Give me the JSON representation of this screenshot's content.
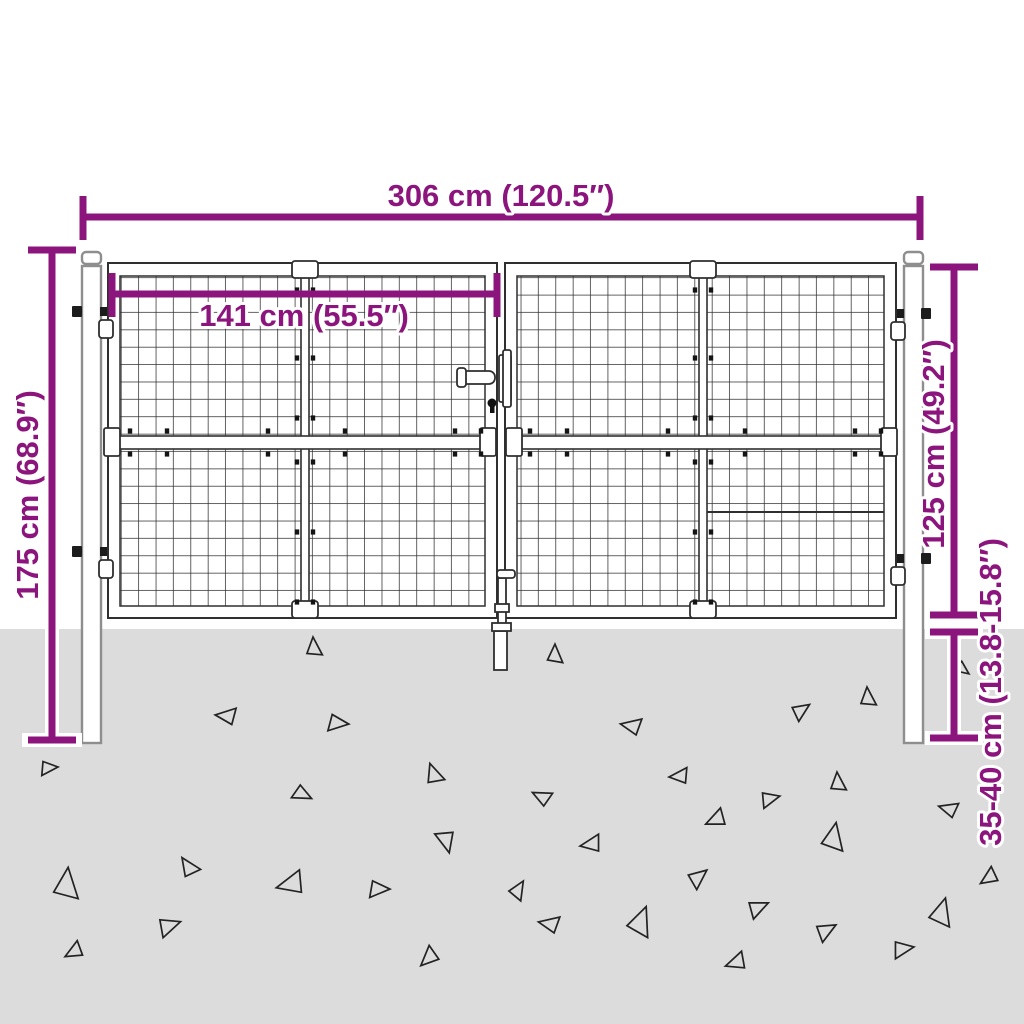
{
  "diagram": {
    "dimensions": {
      "overall_width": {
        "label": "306 cm (120.5″)"
      },
      "leaf_width": {
        "label": "141 cm (55.5″)"
      },
      "post_height": {
        "label": "175 cm (68.9″)"
      },
      "gate_height": {
        "label": "125 cm (49.2″)"
      },
      "ground_depth": {
        "label": "35-40 cm (13.8-15.8″)"
      }
    }
  },
  "colors": {
    "accent": "#8C157D",
    "ground": "#dcdcdc",
    "line": "#2f2f2f",
    "post_outline": "#8e8e8e",
    "background": "#ffffff"
  },
  "decor": {
    "triangles": [
      [
        313,
        648,
        11,
        0
      ],
      [
        227,
        717,
        12,
        -80
      ],
      [
        337,
        722,
        12,
        100
      ],
      [
        48,
        767,
        10,
        90
      ],
      [
        302,
        793,
        11,
        120
      ],
      [
        433,
        775,
        12,
        -15
      ],
      [
        447,
        840,
        13,
        170
      ],
      [
        188,
        868,
        12,
        -30
      ],
      [
        65,
        885,
        18,
        10
      ],
      [
        292,
        885,
        16,
        -100
      ],
      [
        378,
        888,
        12,
        95
      ],
      [
        168,
        925,
        13,
        75
      ],
      [
        75,
        952,
        11,
        -115
      ],
      [
        430,
        958,
        12,
        -130
      ],
      [
        554,
        655,
        11,
        5
      ],
      [
        800,
        710,
        11,
        60
      ],
      [
        867,
        698,
        11,
        0
      ],
      [
        962,
        668,
        9,
        130
      ],
      [
        632,
        727,
        12,
        -75
      ],
      [
        680,
        777,
        11,
        -90
      ],
      [
        542,
        798,
        11,
        -60
      ],
      [
        769,
        798,
        11,
        80
      ],
      [
        837,
        783,
        11,
        0
      ],
      [
        717,
        820,
        12,
        -110
      ],
      [
        949,
        810,
        11,
        -70
      ],
      [
        592,
        845,
        12,
        -95
      ],
      [
        832,
        838,
        16,
        15
      ],
      [
        697,
        877,
        12,
        55
      ],
      [
        517,
        890,
        11,
        35
      ],
      [
        990,
        878,
        11,
        -120
      ],
      [
        757,
        907,
        12,
        70
      ],
      [
        550,
        925,
        12,
        -75
      ],
      [
        639,
        922,
        17,
        25
      ],
      [
        825,
        930,
        12,
        65
      ],
      [
        940,
        913,
        16,
        20
      ],
      [
        902,
        948,
        12,
        85
      ],
      [
        737,
        963,
        12,
        -105
      ]
    ],
    "center_bolt_ys": [
      290,
      358,
      418,
      462,
      532,
      602
    ],
    "center_bar_xs": [
      305,
      703
    ],
    "rail_bolt_xs": [
      130,
      167,
      268,
      345,
      455,
      481,
      530,
      567,
      668,
      745,
      855,
      881
    ],
    "rail_bolt_ys": [
      431,
      454
    ]
  }
}
